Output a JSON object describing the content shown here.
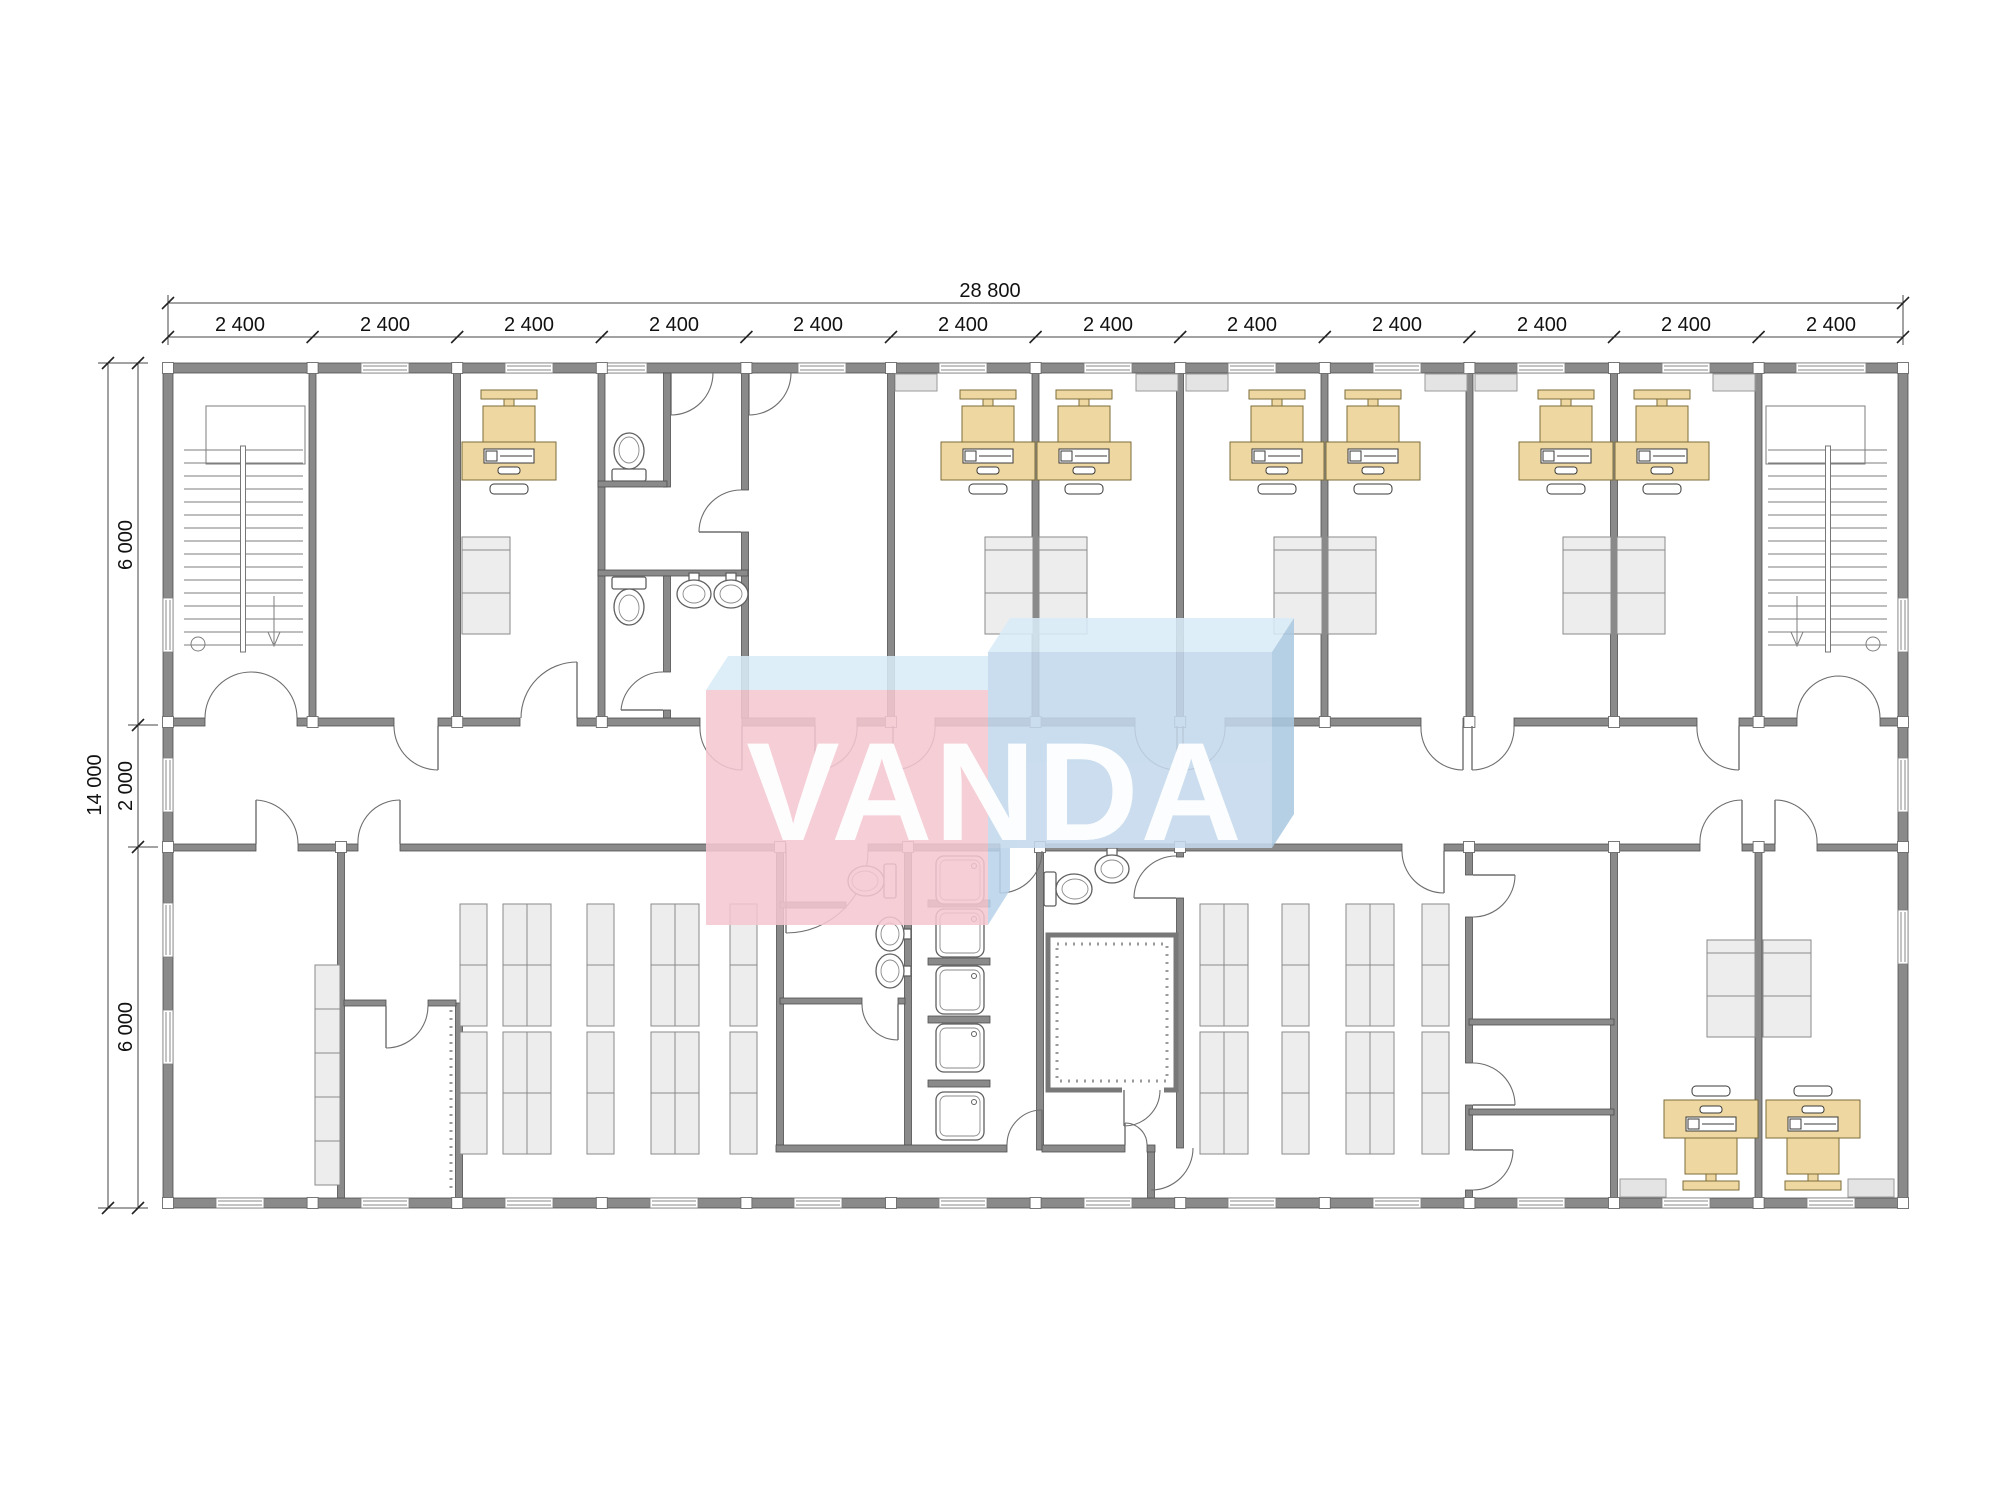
{
  "document": {
    "type": "architectural-floor-plan",
    "background": "#ffffff"
  },
  "watermark": {
    "text": "VANDA",
    "pink": "#f4c7d1",
    "blue": "#c3d8ec",
    "top_face": "#d9ecf8",
    "side_face": "#abc9e2",
    "wedge": "#b9d3ea"
  },
  "dimensions": {
    "overall_width_label": "28 800",
    "overall_height_label": "14 000",
    "module_labels": [
      "2 400",
      "2 400",
      "2 400",
      "2 400",
      "2 400",
      "2 400",
      "2 400",
      "2 400",
      "2 400",
      "2 400",
      "2 400",
      "2 400"
    ],
    "height_segment_labels": [
      "6 000",
      "2 000",
      "6 000"
    ]
  },
  "colors": {
    "wall": "#8a8a8a",
    "furniture": "#ededed",
    "desk": "#eed7a0",
    "dimension_text": "#111111"
  }
}
